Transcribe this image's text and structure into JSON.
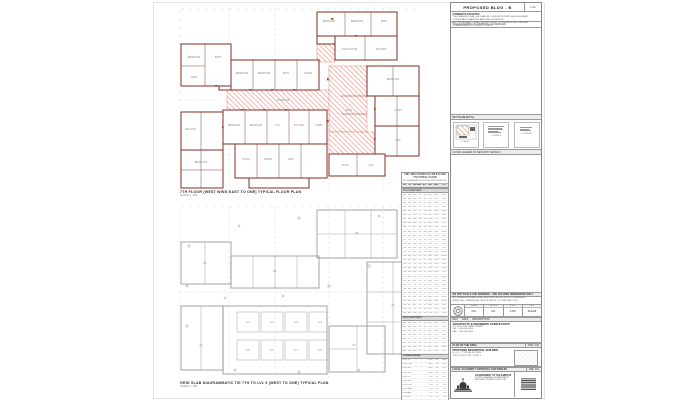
{
  "colors": {
    "wall": "#7d2f27",
    "hatch": "#f0b9b4",
    "door": "#b03a30",
    "outline_gray": "#8f8f8f",
    "grid_dash": "#d8d8d8"
  },
  "sheet": {
    "title": "PROPOSED BLDG - B",
    "ref_box": "A-01",
    "notes": {
      "heading": "COMMENTS ON NOTES",
      "lines": [
        "THIS DRAWING SHALL BE READ IN CONJUNCTION WITH ALL RELEVANT CONSULTANT DRAWINGS AND SPECIFICATIONS.",
        "ANY DISCREPANCY SHALL BE REPORTED TO THE ARCHITECT BEFORE COMMENCEMENT OF WORK ON SITE."
      ]
    },
    "status_line": "STAGE DRAWING OF APPROVAL AS DETAILED",
    "key_plan": {
      "label": "KEY PLAN (N.T.S.)",
      "cells": [
        {
          "caption": "1. LEVEL 7"
        },
        {
          "caption": "2. LEVEL 6"
        },
        {
          "caption": "3. LEGEND"
        }
      ],
      "footer": "FLOOR LEGEND OF SECURITY DETAILS"
    },
    "info_bar": "DO NOT SCALE THE DRAWING - USE FIGURED DIMENSIONS ONLY",
    "info_lines": [
      "ALL DIMENSIONS ARE IN MILLIMETRES UNLESS NOTED OTHERWISE.",
      "VERIFY ALL DIMENSIONS ON SITE PRIOR TO CONSTRUCTION."
    ],
    "credits": {
      "cols": [
        {
          "h": "DRAWN",
          "v": "M.G."
        },
        {
          "h": "CHECKED",
          "v": "A.R."
        },
        {
          "h": "SCALE",
          "v": "1:100"
        },
        {
          "h": "DATE",
          "v": "06.2019"
        }
      ]
    },
    "revision_bar": "REV      DATE      DESCRIPTION",
    "firm": {
      "name": "ARCHITECTS & ENGINEERS CONSULTANTS",
      "lines": [
        "P.O. BOX 1234, MAIN STREET",
        "TEL : +000 000 0000",
        "FAX : +000 000 0000"
      ]
    },
    "area_bar": {
      "left": "PLAN OF THE AREA",
      "right": "DRG. NO."
    },
    "project": {
      "lines": [
        "PROPOSED RESIDENTIAL BUILDING",
        "B + G + 7 TYPICAL FLOORS",
        "ON PLOT NO. 123 - ZONE 1"
      ]
    },
    "approval_bar": {
      "left": "LOCAL AUTHORITY APPROVAL FOR PRELIM.",
      "right": "REF. NO."
    },
    "footer": {
      "lines": [
        "GOVERNMENT OF THE EMIRATE",
        "TOWN PLANNING DEPARTMENT",
        "BUILDING PERMITS SECTION"
      ]
    }
  },
  "plans": {
    "upper": {
      "caption": "7TH FLOOR (WEST WING EAST TO ONE) TYPICAL FLOOR PLAN",
      "scale": "SCALE 1 : 100",
      "labels": [
        {
          "x": 150,
          "y": 14,
          "t": "BEDROOM"
        },
        {
          "x": 178,
          "y": 14,
          "t": "BEDROOM"
        },
        {
          "x": 205,
          "y": 14,
          "t": "BATH"
        },
        {
          "x": 170,
          "y": 42,
          "t": "LIVING ROOM"
        },
        {
          "x": 202,
          "y": 42,
          "t": "KITCHEN"
        },
        {
          "x": 63,
          "y": 66,
          "t": "BEDROOM"
        },
        {
          "x": 85,
          "y": 66,
          "t": "BEDROOM"
        },
        {
          "x": 107,
          "y": 66,
          "t": "BATH"
        },
        {
          "x": 129,
          "y": 66,
          "t": "STORE"
        },
        {
          "x": 15,
          "y": 50,
          "t": "BEDROOM"
        },
        {
          "x": 39,
          "y": 50,
          "t": "BATH"
        },
        {
          "x": 15,
          "y": 70,
          "t": "MAID"
        },
        {
          "x": 104,
          "y": 93,
          "t": "CORRIDOR"
        },
        {
          "x": 55,
          "y": 118,
          "t": "BEDROOM"
        },
        {
          "x": 77,
          "y": 118,
          "t": "BEDROOM"
        },
        {
          "x": 99,
          "y": 118,
          "t": "W.C."
        },
        {
          "x": 120,
          "y": 118,
          "t": "KITCHEN"
        },
        {
          "x": 140,
          "y": 118,
          "t": "LOBBY"
        },
        {
          "x": 67,
          "y": 152,
          "t": "LIVING"
        },
        {
          "x": 89,
          "y": 152,
          "t": "DINING"
        },
        {
          "x": 112,
          "y": 152,
          "t": "BED"
        },
        {
          "x": 12,
          "y": 122,
          "t": "BALCONY"
        },
        {
          "x": 22,
          "y": 155,
          "t": "BEDROOM"
        },
        {
          "x": 214,
          "y": 72,
          "t": "BEDROOM"
        },
        {
          "x": 219,
          "y": 103,
          "t": "LIVING"
        },
        {
          "x": 219,
          "y": 133,
          "t": "BED"
        },
        {
          "x": 170,
          "y": 103,
          "t": "BATH"
        },
        {
          "x": 166,
          "y": 158,
          "t": "STAIR"
        },
        {
          "x": 192,
          "y": 158,
          "t": "LIFT"
        }
      ]
    },
    "lower": {
      "caption": "GRID SLAB DIAGRAMMATIC TIE 7TH TO LVL 6 (WEST TO ONE) TYPICAL PLAN",
      "scale": "SCALE 1 : 100",
      "labels": [
        {
          "x": 69,
          "y": 117,
          "t": "C1"
        },
        {
          "x": 93,
          "y": 117,
          "t": "C2"
        },
        {
          "x": 117,
          "y": 117,
          "t": "C3"
        },
        {
          "x": 141,
          "y": 117,
          "t": "C4"
        },
        {
          "x": 69,
          "y": 145,
          "t": "C5"
        },
        {
          "x": 93,
          "y": 145,
          "t": "C6"
        },
        {
          "x": 117,
          "y": 145,
          "t": "C7"
        },
        {
          "x": 141,
          "y": 145,
          "t": "C8"
        },
        {
          "x": 178,
          "y": 28,
          "t": "B1"
        },
        {
          "x": 96,
          "y": 66,
          "t": "B2"
        },
        {
          "x": 26,
          "y": 58,
          "t": "B3"
        },
        {
          "x": 214,
          "y": 100,
          "t": "S1"
        },
        {
          "x": 22,
          "y": 140,
          "t": "S2"
        },
        {
          "x": 175,
          "y": 140,
          "t": "S3"
        }
      ],
      "markers": [
        {
          "x": 10,
          "y": 40,
          "k": "c"
        },
        {
          "x": 60,
          "y": 20,
          "k": "x"
        },
        {
          "x": 120,
          "y": 12,
          "k": "c"
        },
        {
          "x": 200,
          "y": 10,
          "k": "x"
        },
        {
          "x": 232,
          "y": 40,
          "k": "c"
        },
        {
          "x": 236,
          "y": 96,
          "k": "x"
        },
        {
          "x": 228,
          "y": 150,
          "k": "c"
        },
        {
          "x": 180,
          "y": 164,
          "k": "x"
        },
        {
          "x": 120,
          "y": 166,
          "k": "c"
        },
        {
          "x": 56,
          "y": 164,
          "k": "x"
        },
        {
          "x": 8,
          "y": 120,
          "k": "c"
        },
        {
          "x": 8,
          "y": 80,
          "k": "x"
        },
        {
          "x": 150,
          "y": 80,
          "k": "c"
        },
        {
          "x": 46,
          "y": 92,
          "k": "x"
        },
        {
          "x": 190,
          "y": 60,
          "k": "c"
        },
        {
          "x": 104,
          "y": 90,
          "k": "x"
        }
      ]
    }
  },
  "schedule": {
    "title_lines": [
      "UNIT AREA SCHEDULE FOR 6TH AND 7TH TYPICAL FLOOR",
      "ALL AREAS ARE IN SQ.M. AS PER SCHEDULE"
    ],
    "headers": [
      "NO",
      "TYP",
      "RM",
      "BAL",
      "A/C",
      "NET",
      "GRS",
      "TOT"
    ],
    "sections": [
      {
        "band": "7TH FLOOR UNITS",
        "band_val": "",
        "rows": [
          [
            "701",
            "A1",
            "12.4",
            "3.2",
            "1.6",
            "84.2",
            "18.6",
            "102.8"
          ],
          [
            "702",
            "A2",
            "11.8",
            "2.8",
            "1.4",
            "78.6",
            "17.2",
            "95.8"
          ],
          [
            "703",
            "B1",
            "10.6",
            "2.4",
            "1.2",
            "64.3",
            "14.8",
            "79.1"
          ],
          [
            "704",
            "B2",
            "10.2",
            "2.6",
            "1.2",
            "66.1",
            "15.0",
            "81.1"
          ],
          [
            "705",
            "A1",
            "12.4",
            "3.2",
            "1.6",
            "84.2",
            "18.6",
            "102.8"
          ],
          [
            "706",
            "C1",
            "9.4",
            "2.2",
            "1.0",
            "52.7",
            "12.4",
            "65.1"
          ],
          [
            "707",
            "A2",
            "11.8",
            "2.8",
            "1.4",
            "78.6",
            "17.2",
            "95.8"
          ],
          [
            "708",
            "B1",
            "10.6",
            "2.4",
            "1.2",
            "64.3",
            "14.8",
            "79.1"
          ],
          [
            "709",
            "D1",
            "14.2",
            "3.6",
            "1.8",
            "96.4",
            "21.2",
            "117.6"
          ],
          [
            "710",
            "A1",
            "12.4",
            "3.2",
            "1.6",
            "84.2",
            "18.6",
            "102.8"
          ],
          [
            "711",
            "B2",
            "10.2",
            "2.6",
            "1.2",
            "66.1",
            "15.0",
            "81.1"
          ],
          [
            "712",
            "C1",
            "9.4",
            "2.2",
            "1.0",
            "52.7",
            "12.4",
            "65.1"
          ],
          [
            "713",
            "A2",
            "11.8",
            "2.8",
            "1.4",
            "78.6",
            "17.2",
            "95.8"
          ],
          [
            "714",
            "B1",
            "10.6",
            "2.4",
            "1.2",
            "64.3",
            "14.8",
            "79.1"
          ],
          [
            "715",
            "D1",
            "14.2",
            "3.6",
            "1.8",
            "96.4",
            "21.2",
            "117.6"
          ],
          [
            "716",
            "A1",
            "12.4",
            "3.2",
            "1.6",
            "84.2",
            "18.6",
            "102.8"
          ],
          [
            "717",
            "B2",
            "10.2",
            "2.6",
            "1.2",
            "66.1",
            "15.0",
            "81.1"
          ],
          [
            "718",
            "C1",
            "9.4",
            "2.2",
            "1.0",
            "52.7",
            "12.4",
            "65.1"
          ],
          [
            "719",
            "A2",
            "11.8",
            "2.8",
            "1.4",
            "78.6",
            "17.2",
            "95.8"
          ],
          [
            "720",
            "B1",
            "10.6",
            "2.4",
            "1.2",
            "64.3",
            "14.8",
            "79.1"
          ],
          [
            "721",
            "A1",
            "12.4",
            "3.2",
            "1.6",
            "84.2",
            "18.6",
            "102.8"
          ],
          [
            "722",
            "B2",
            "10.2",
            "2.6",
            "1.2",
            "66.1",
            "15.0",
            "81.1"
          ],
          [
            "723",
            "C1",
            "9.4",
            "2.2",
            "1.0",
            "52.7",
            "12.4",
            "65.1"
          ],
          [
            "724",
            "A2",
            "11.8",
            "2.8",
            "1.4",
            "78.6",
            "17.2",
            "95.8"
          ],
          [
            "725",
            "B1",
            "10.6",
            "2.4",
            "1.2",
            "64.3",
            "14.8",
            "79.1"
          ],
          [
            "726",
            "D1",
            "14.2",
            "3.6",
            "1.8",
            "96.4",
            "21.2",
            "117.6"
          ],
          [
            "727",
            "A1",
            "12.4",
            "3.2",
            "1.6",
            "84.2",
            "18.6",
            "102.8"
          ],
          [
            "728",
            "B2",
            "10.2",
            "2.6",
            "1.2",
            "66.1",
            "15.0",
            "81.1"
          ],
          [
            "729",
            "C1",
            "9.4",
            "2.2",
            "1.0",
            "52.7",
            "12.4",
            "65.1"
          ],
          [
            "730",
            "A2",
            "11.8",
            "2.8",
            "1.4",
            "78.6",
            "17.2",
            "95.8"
          ]
        ]
      },
      {
        "band": "6TH FLOOR UNITS",
        "band_val": "",
        "rows": [
          [
            "601",
            "A1",
            "12.4",
            "3.2",
            "1.6",
            "84.2",
            "18.6",
            "102.8"
          ],
          [
            "602",
            "A2",
            "11.8",
            "2.8",
            "1.4",
            "78.6",
            "17.2",
            "95.8"
          ],
          [
            "603",
            "B1",
            "10.6",
            "2.4",
            "1.2",
            "64.3",
            "14.8",
            "79.1"
          ],
          [
            "604",
            "B2",
            "10.2",
            "2.6",
            "1.2",
            "66.1",
            "15.0",
            "81.1"
          ],
          [
            "605",
            "C1",
            "9.4",
            "2.2",
            "1.0",
            "52.7",
            "12.4",
            "65.1"
          ],
          [
            "606",
            "D1",
            "14.2",
            "3.6",
            "1.8",
            "96.4",
            "21.2",
            "117.6"
          ],
          [
            "607",
            "A1",
            "12.4",
            "3.2",
            "1.6",
            "84.2",
            "18.6",
            "102.8"
          ],
          [
            "608",
            "B1",
            "10.6",
            "2.4",
            "1.2",
            "64.3",
            "14.8",
            "79.1"
          ]
        ]
      },
      {
        "band": "COMMON AREAS",
        "band_val": "",
        "rows": [
          [
            "C-01",
            "LL",
            "-",
            "-",
            "-",
            "24.6",
            "6.2",
            "30.8"
          ],
          [
            "C-02",
            "COR",
            "-",
            "-",
            "-",
            "48.2",
            "9.6",
            "57.8"
          ],
          [
            "C-03",
            "ST1",
            "-",
            "-",
            "-",
            "16.4",
            "3.8",
            "20.2"
          ],
          [
            "C-04",
            "ST2",
            "-",
            "-",
            "-",
            "16.4",
            "3.8",
            "20.2"
          ],
          [
            "C-05",
            "LFT",
            "-",
            "-",
            "-",
            "8.6",
            "2.1",
            "10.7"
          ],
          [
            "C-06",
            "SVC",
            "-",
            "-",
            "-",
            "6.2",
            "1.5",
            "7.7"
          ],
          [
            "C-07",
            "ELE",
            "-",
            "-",
            "-",
            "4.8",
            "1.2",
            "6.0"
          ],
          [
            "C-08",
            "GAR",
            "-",
            "-",
            "-",
            "5.4",
            "1.3",
            "6.7"
          ],
          [
            "C-09",
            "AHU",
            "-",
            "-",
            "-",
            "9.2",
            "2.2",
            "11.4"
          ],
          [
            "C-10",
            "DCT",
            "-",
            "-",
            "-",
            "3.6",
            "0.9",
            "4.5"
          ],
          [
            "C-11",
            "PMP",
            "-",
            "-",
            "-",
            "7.4",
            "1.8",
            "9.2"
          ],
          [
            "C-12",
            "TEL",
            "-",
            "-",
            "-",
            "4.2",
            "1.0",
            "5.2"
          ],
          [
            "C-13",
            "BAL",
            "-",
            "-",
            "-",
            "18.6",
            "4.4",
            "23.0"
          ]
        ]
      },
      {
        "band": "GRAND TOTAL",
        "band_val": "3,248.6",
        "rows": []
      }
    ]
  }
}
